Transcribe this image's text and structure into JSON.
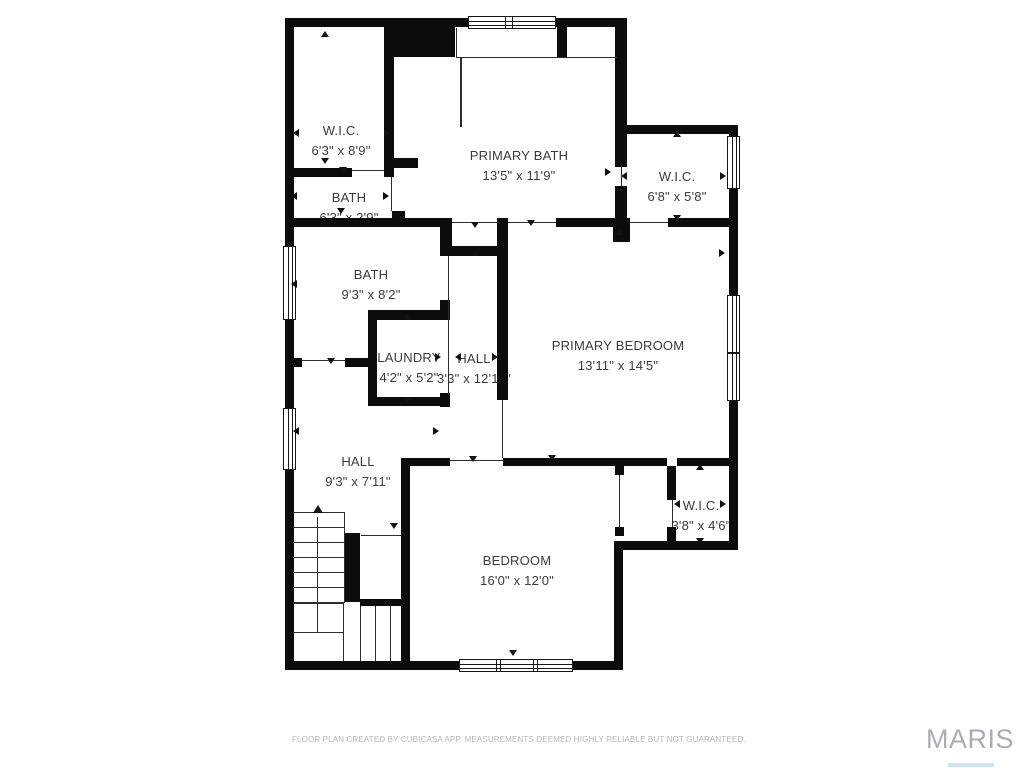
{
  "plan": {
    "wall_color": "#0c0c0c",
    "line_color": "#2e2e2e",
    "text_color": "#3b3b3b",
    "rooms": [
      {
        "name": "W.I.C.",
        "dims": "6'3\" x 8'9\"",
        "x": 341,
        "y": 131
      },
      {
        "name": "BATH",
        "dims": "6'3\" x 2'9\"",
        "x": 349,
        "y": 198
      },
      {
        "name": "PRIMARY BATH",
        "dims": "13'5\" x 11'9\"",
        "x": 519,
        "y": 156
      },
      {
        "name": "W.I.C.",
        "dims": "6'8\" x 5'8\"",
        "x": 677,
        "y": 177
      },
      {
        "name": "BATH",
        "dims": "9'3\" x 8'2\"",
        "x": 371,
        "y": 275
      },
      {
        "name": "LAUNDRY",
        "dims": "4'2\" x 5'2\"",
        "x": 409,
        "y": 358
      },
      {
        "name": "HALL",
        "dims": "3'3\" x 12'10\"",
        "x": 474,
        "y": 359
      },
      {
        "name": "PRIMARY BEDROOM",
        "dims": "13'11\" x 14'5\"",
        "x": 618,
        "y": 346
      },
      {
        "name": "HALL",
        "dims": "9'3\" x 7'11\"",
        "x": 358,
        "y": 462
      },
      {
        "name": "W.I.C.",
        "dims": "3'8\" x 4'6\"",
        "x": 701,
        "y": 506
      },
      {
        "name": "BEDROOM",
        "dims": "16'0\" x 12'0\"",
        "x": 517,
        "y": 561
      }
    ],
    "walls": [
      [
        285,
        18,
        9,
        230
      ],
      [
        285,
        320,
        9,
        90
      ],
      [
        285,
        470,
        9,
        200
      ],
      [
        285,
        18,
        183,
        9
      ],
      [
        556,
        18,
        71,
        9
      ],
      [
        615,
        18,
        12,
        149
      ],
      [
        615,
        186,
        12,
        41
      ],
      [
        615,
        125,
        123,
        9
      ],
      [
        729,
        125,
        9,
        13
      ],
      [
        729,
        188,
        9,
        109
      ],
      [
        729,
        400,
        9,
        150
      ],
      [
        614,
        541,
        124,
        9
      ],
      [
        614,
        550,
        9,
        120
      ],
      [
        285,
        661,
        175,
        9
      ],
      [
        573,
        661,
        50,
        9
      ],
      [
        384,
        18,
        10,
        159
      ],
      [
        394,
        158,
        24,
        10
      ],
      [
        285,
        168,
        67,
        9
      ],
      [
        393,
        27,
        62,
        30
      ],
      [
        557,
        27,
        10,
        30
      ],
      [
        392,
        211,
        13,
        9
      ],
      [
        285,
        218,
        158,
        9
      ],
      [
        440,
        218,
        12,
        38
      ],
      [
        442,
        246,
        65,
        10
      ],
      [
        497,
        218,
        11,
        182
      ],
      [
        556,
        218,
        65,
        9
      ],
      [
        613,
        218,
        17,
        24
      ],
      [
        668,
        218,
        61,
        9
      ],
      [
        368,
        310,
        75,
        10
      ],
      [
        440,
        300,
        10,
        20
      ],
      [
        368,
        310,
        9,
        93
      ],
      [
        285,
        358,
        17,
        9
      ],
      [
        345,
        358,
        23,
        9
      ],
      [
        368,
        397,
        75,
        9
      ],
      [
        440,
        393,
        10,
        14
      ],
      [
        401,
        458,
        49,
        8
      ],
      [
        503,
        458,
        164,
        8
      ],
      [
        615,
        466,
        9,
        9
      ],
      [
        615,
        527,
        9,
        9
      ],
      [
        667,
        466,
        9,
        34
      ],
      [
        667,
        527,
        9,
        14
      ],
      [
        677,
        458,
        52,
        8
      ],
      [
        401,
        458,
        9,
        212
      ],
      [
        344,
        533,
        16,
        69
      ],
      [
        360,
        599,
        41,
        7
      ]
    ],
    "glass_lines": [
      [
        456,
        28,
        1,
        29
      ],
      [
        456,
        57,
        161,
        1
      ],
      [
        460,
        57,
        2,
        70
      ]
    ],
    "opening_lines": [
      [
        352,
        170,
        32,
        1
      ],
      [
        391,
        177,
        1,
        34
      ],
      [
        452,
        222,
        45,
        1
      ],
      [
        508,
        222,
        48,
        1
      ],
      [
        630,
        222,
        38,
        1
      ],
      [
        621,
        167,
        1,
        19
      ],
      [
        448,
        256,
        1,
        139
      ],
      [
        450,
        460,
        53,
        1
      ],
      [
        502,
        400,
        1,
        58
      ],
      [
        619,
        475,
        1,
        52
      ],
      [
        672,
        500,
        1,
        27
      ],
      [
        302,
        360,
        43,
        1
      ],
      [
        361,
        535,
        40,
        1
      ]
    ],
    "stair_lines": [
      [
        293,
        512,
        51,
        1
      ],
      [
        293,
        527,
        51,
        1
      ],
      [
        293,
        542,
        51,
        1
      ],
      [
        293,
        557,
        51,
        1
      ],
      [
        293,
        572,
        51,
        1
      ],
      [
        293,
        587,
        51,
        1
      ],
      [
        293,
        602,
        51,
        1
      ],
      [
        344,
        512,
        1,
        91
      ],
      [
        293,
        603,
        51,
        1
      ],
      [
        293,
        632,
        51,
        1
      ],
      [
        343,
        603,
        1,
        58
      ],
      [
        360,
        606,
        1,
        55
      ],
      [
        375,
        606,
        1,
        55
      ],
      [
        390,
        606,
        1,
        55
      ],
      [
        317,
        517,
        1,
        115
      ]
    ],
    "windows": [
      {
        "x": 468,
        "y": 16,
        "w": 88,
        "h": 13,
        "dir": "h",
        "mullions": [
          505,
          512
        ]
      },
      {
        "x": 727,
        "y": 136,
        "w": 13,
        "h": 53,
        "dir": "v",
        "mullions": []
      },
      {
        "x": 727,
        "y": 295,
        "w": 13,
        "h": 58,
        "dir": "v",
        "mullions": []
      },
      {
        "x": 727,
        "y": 353,
        "w": 13,
        "h": 48,
        "dir": "v",
        "mullions": []
      },
      {
        "x": 283,
        "y": 246,
        "w": 13,
        "h": 74,
        "dir": "v",
        "mullions": []
      },
      {
        "x": 283,
        "y": 408,
        "w": 13,
        "h": 62,
        "dir": "v",
        "mullions": []
      },
      {
        "x": 459,
        "y": 659,
        "w": 114,
        "h": 13,
        "dir": "h",
        "mullions": [
          496,
          500,
          533,
          537
        ]
      }
    ],
    "arrows": [
      [
        325,
        31,
        "up"
      ],
      [
        293,
        133,
        "left"
      ],
      [
        390,
        133,
        "right"
      ],
      [
        325,
        164,
        "down"
      ],
      [
        343,
        173,
        "down"
      ],
      [
        291,
        196,
        "left"
      ],
      [
        389,
        196,
        "right"
      ],
      [
        341,
        214,
        "down"
      ],
      [
        611,
        172,
        "right"
      ],
      [
        475,
        228,
        "down"
      ],
      [
        531,
        226,
        "down"
      ],
      [
        475,
        250,
        "up"
      ],
      [
        677,
        131,
        "up"
      ],
      [
        621,
        176,
        "left"
      ],
      [
        726,
        176,
        "right"
      ],
      [
        677,
        221,
        "down"
      ],
      [
        291,
        284,
        "left"
      ],
      [
        331,
        364,
        "down"
      ],
      [
        441,
        357,
        "right"
      ],
      [
        455,
        357,
        "left"
      ],
      [
        498,
        357,
        "right"
      ],
      [
        293,
        431,
        "left"
      ],
      [
        439,
        431,
        "right"
      ],
      [
        619,
        229,
        "up"
      ],
      [
        725,
        253,
        "right"
      ],
      [
        552,
        461,
        "down"
      ],
      [
        473,
        462,
        "down"
      ],
      [
        513,
        656,
        "down"
      ],
      [
        700,
        464,
        "up"
      ],
      [
        674,
        504,
        "left"
      ],
      [
        726,
        504,
        "right"
      ],
      [
        700,
        544,
        "down"
      ],
      [
        394,
        529,
        "down"
      ],
      [
        407,
        313,
        "up"
      ],
      [
        407,
        404,
        "down"
      ]
    ],
    "stair_arrow": {
      "x": 318,
      "y": 505
    }
  },
  "footer": {
    "disclaimer": "FLOOR PLAN CREATED BY CUBICASA APP. MEASUREMENTS DEEMED HIGHLY RELIABLE BUT NOT GUARANTEED.",
    "watermark": "MARIS"
  }
}
